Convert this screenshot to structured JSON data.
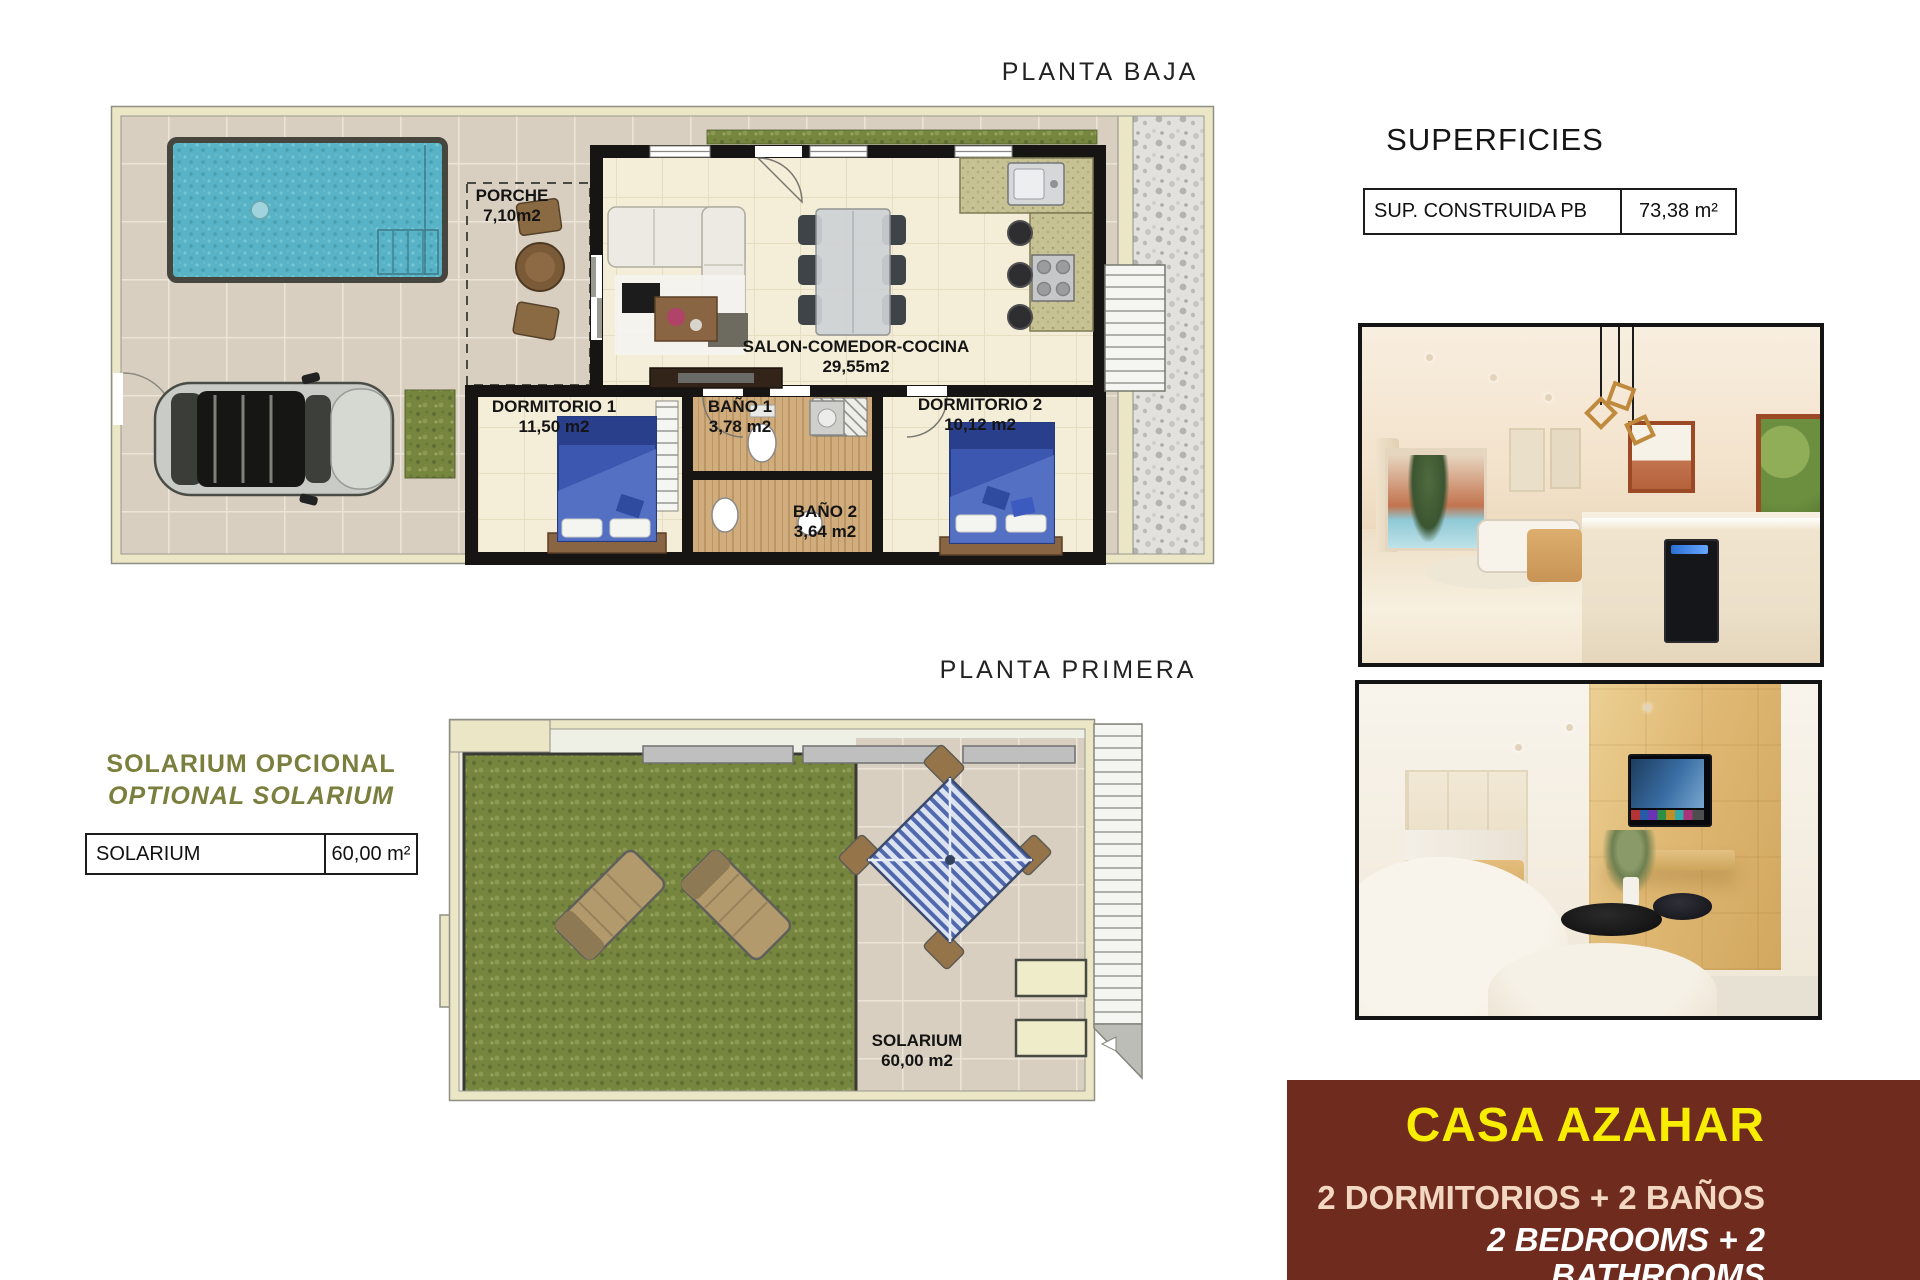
{
  "plans": {
    "planta_baja": {
      "title": "PLANTA BAJA",
      "rooms": {
        "porche": {
          "name": "PORCHE",
          "area": "7,10m2"
        },
        "salon": {
          "name": "SALON-COMEDOR-COCINA",
          "area": "29,55m2"
        },
        "dormitorio1": {
          "name": "DORMITORIO 1",
          "area": "11,50 m2"
        },
        "bano1": {
          "name": "BAÑO 1",
          "area": "3,78 m2"
        },
        "bano2": {
          "name": "BAÑO 2",
          "area": "3,64 m2"
        },
        "dormitorio2": {
          "name": "DORMITORIO 2",
          "area": "10,12 m2"
        }
      }
    },
    "planta_primera": {
      "title": "PLANTA PRIMERA",
      "rooms": {
        "solarium": {
          "name": "SOLARIUM",
          "area": "60,00 m2"
        }
      }
    }
  },
  "superficies": {
    "title": "SUPERFICIES",
    "rows": [
      {
        "label": "SUP. CONSTRUIDA PB",
        "value": "73,38 m²"
      }
    ]
  },
  "solarium_option": {
    "heading_es": "SOLARIUM OPCIONAL",
    "heading_en": "OPTIONAL SOLARIUM",
    "table": {
      "label": "SOLARIUM",
      "value": "60,00 m²"
    }
  },
  "property_card": {
    "name": "CASA AZAHAR",
    "spec_es": "2 DORMITORIOS + 2 BAÑOS",
    "spec_en": "2 BEDROOMS + 2 BATHROOMS"
  },
  "colors": {
    "card_bg": "#6f2b1d",
    "card_name": "#f7ed00",
    "card_spec_es": "#f2d8c3",
    "card_spec_en": "#ffffff",
    "accent_olive": "#7a7f3d",
    "pool_water": "#57b3c5",
    "grass": "#77863f",
    "terrace_tile": "#d9cfc0",
    "plan_wall_cream": "#eae6c6"
  }
}
